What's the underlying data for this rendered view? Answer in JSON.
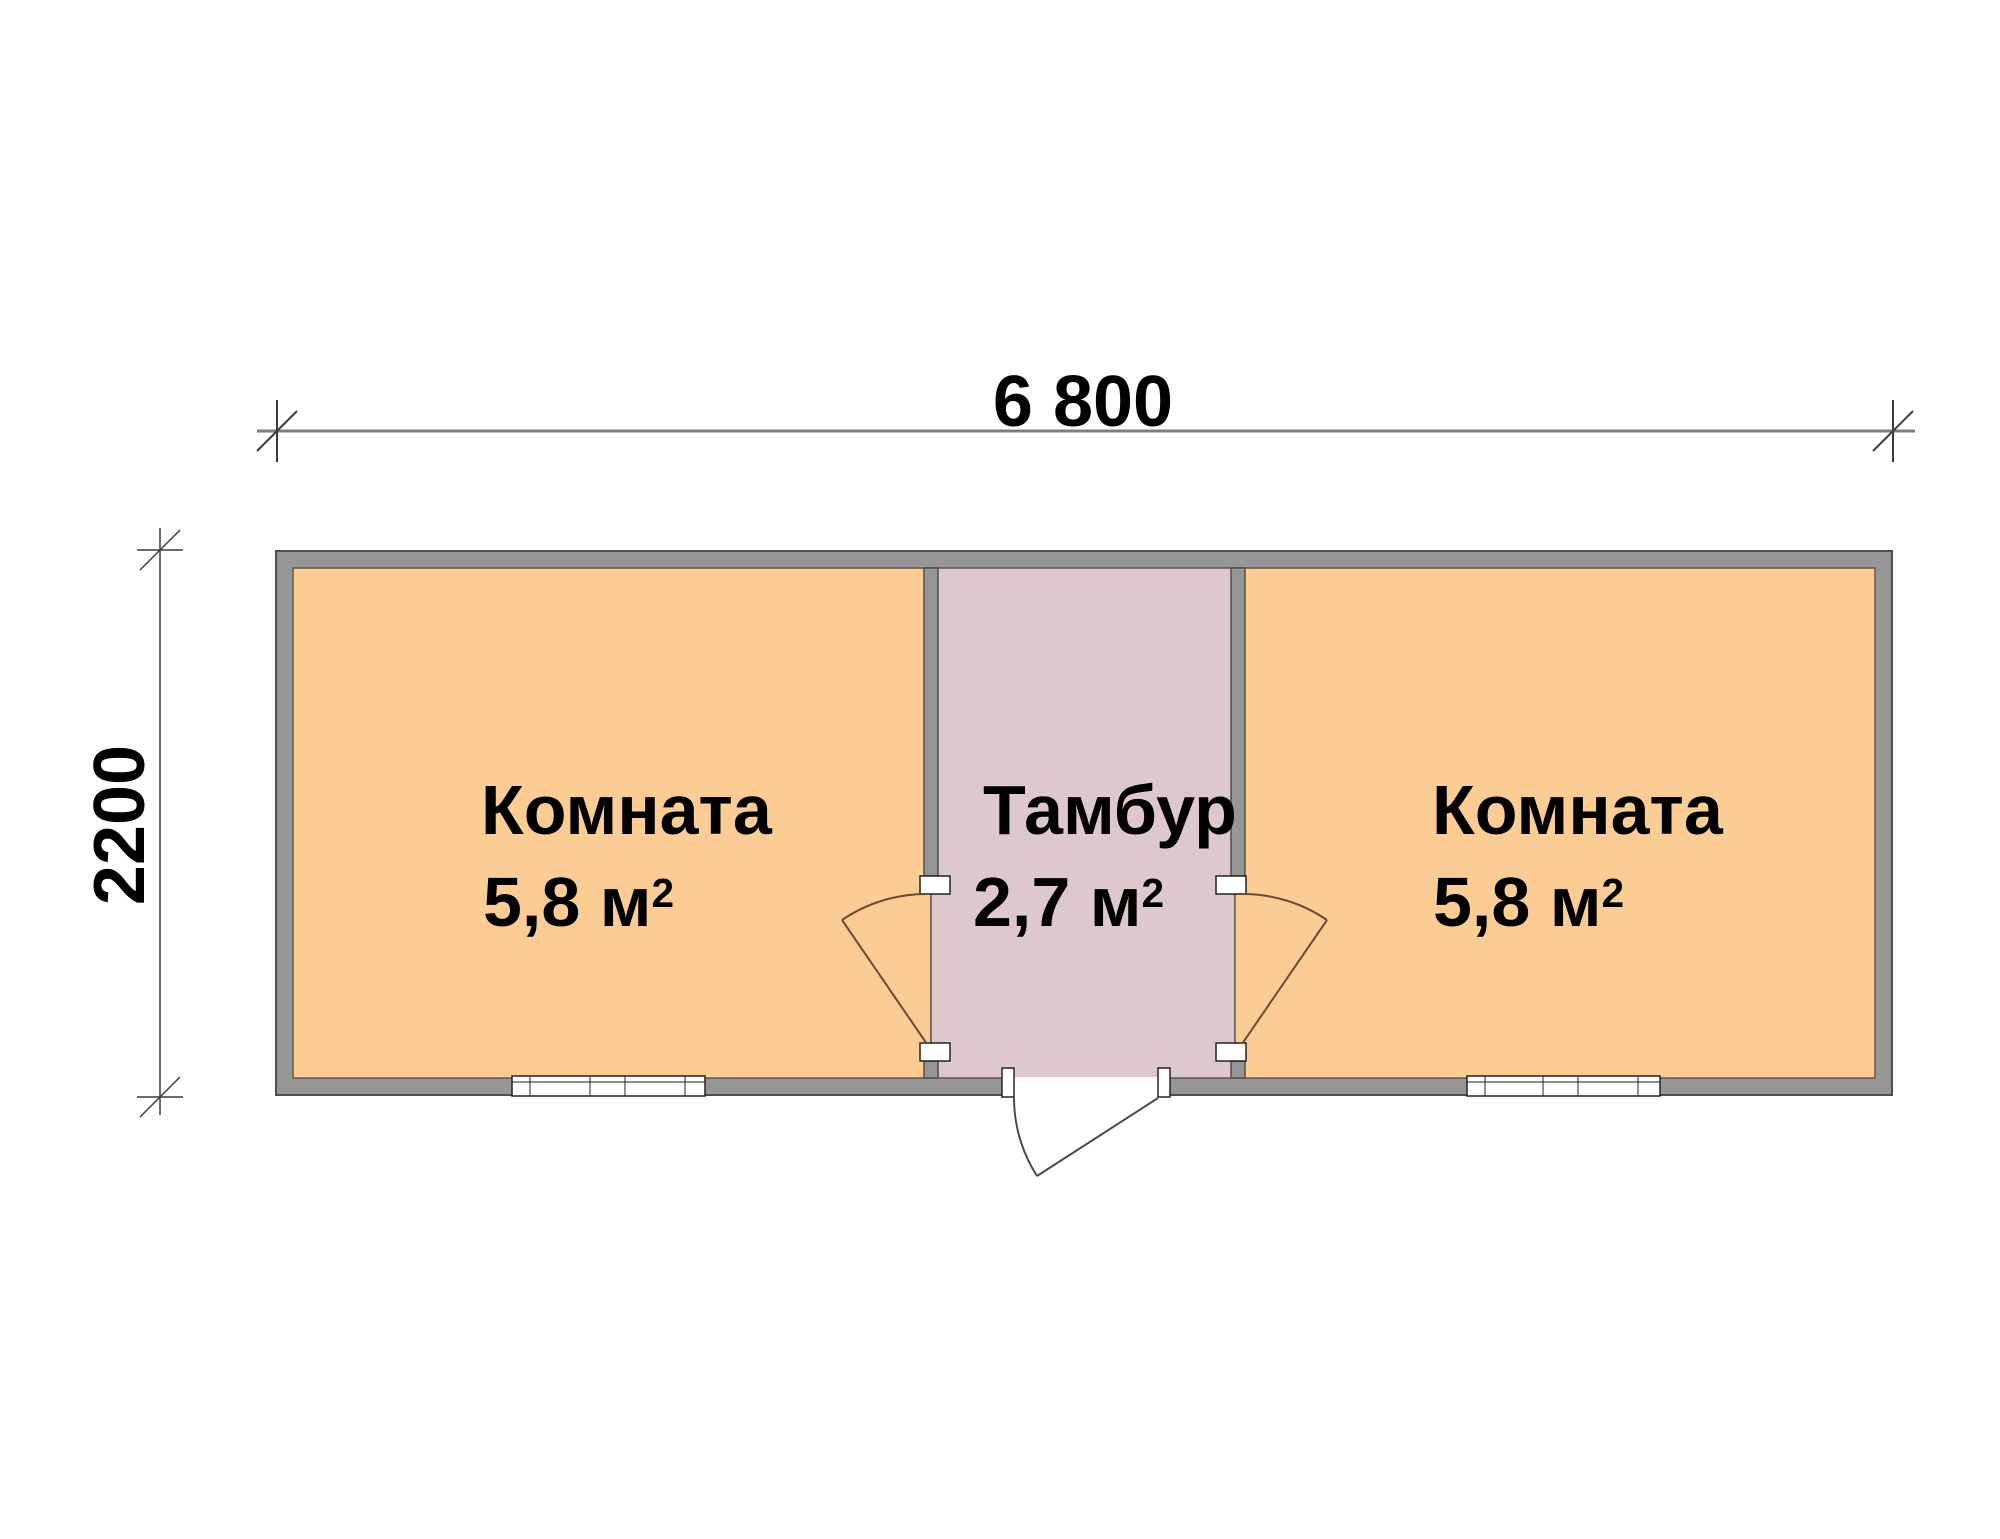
{
  "plan": {
    "type": "floor-plan",
    "dimensions": {
      "width_label": "6 800",
      "height_label": "2200"
    },
    "rooms": [
      {
        "name": "Комната",
        "area_value": "5,8 м",
        "area_sup": "2"
      },
      {
        "name": "Тамбур",
        "area_value": "2,7 м",
        "area_sup": "2"
      },
      {
        "name": "Комната",
        "area_value": "5,8 м",
        "area_sup": "2"
      }
    ],
    "colors": {
      "room_fill": "#fccc95",
      "vestibule_fill": "#dcc8cd",
      "wall_fill": "#969696",
      "wall_outline": "#4f4f4f",
      "floor_edge": "#5f5a50",
      "dimension_line": "#7f7f7f",
      "tick_line": "#3c3c3c",
      "door_interior_line": "#6e4b2f",
      "door_entrance_line": "#4a4a4a",
      "frame_white": "#ffffff"
    }
  }
}
